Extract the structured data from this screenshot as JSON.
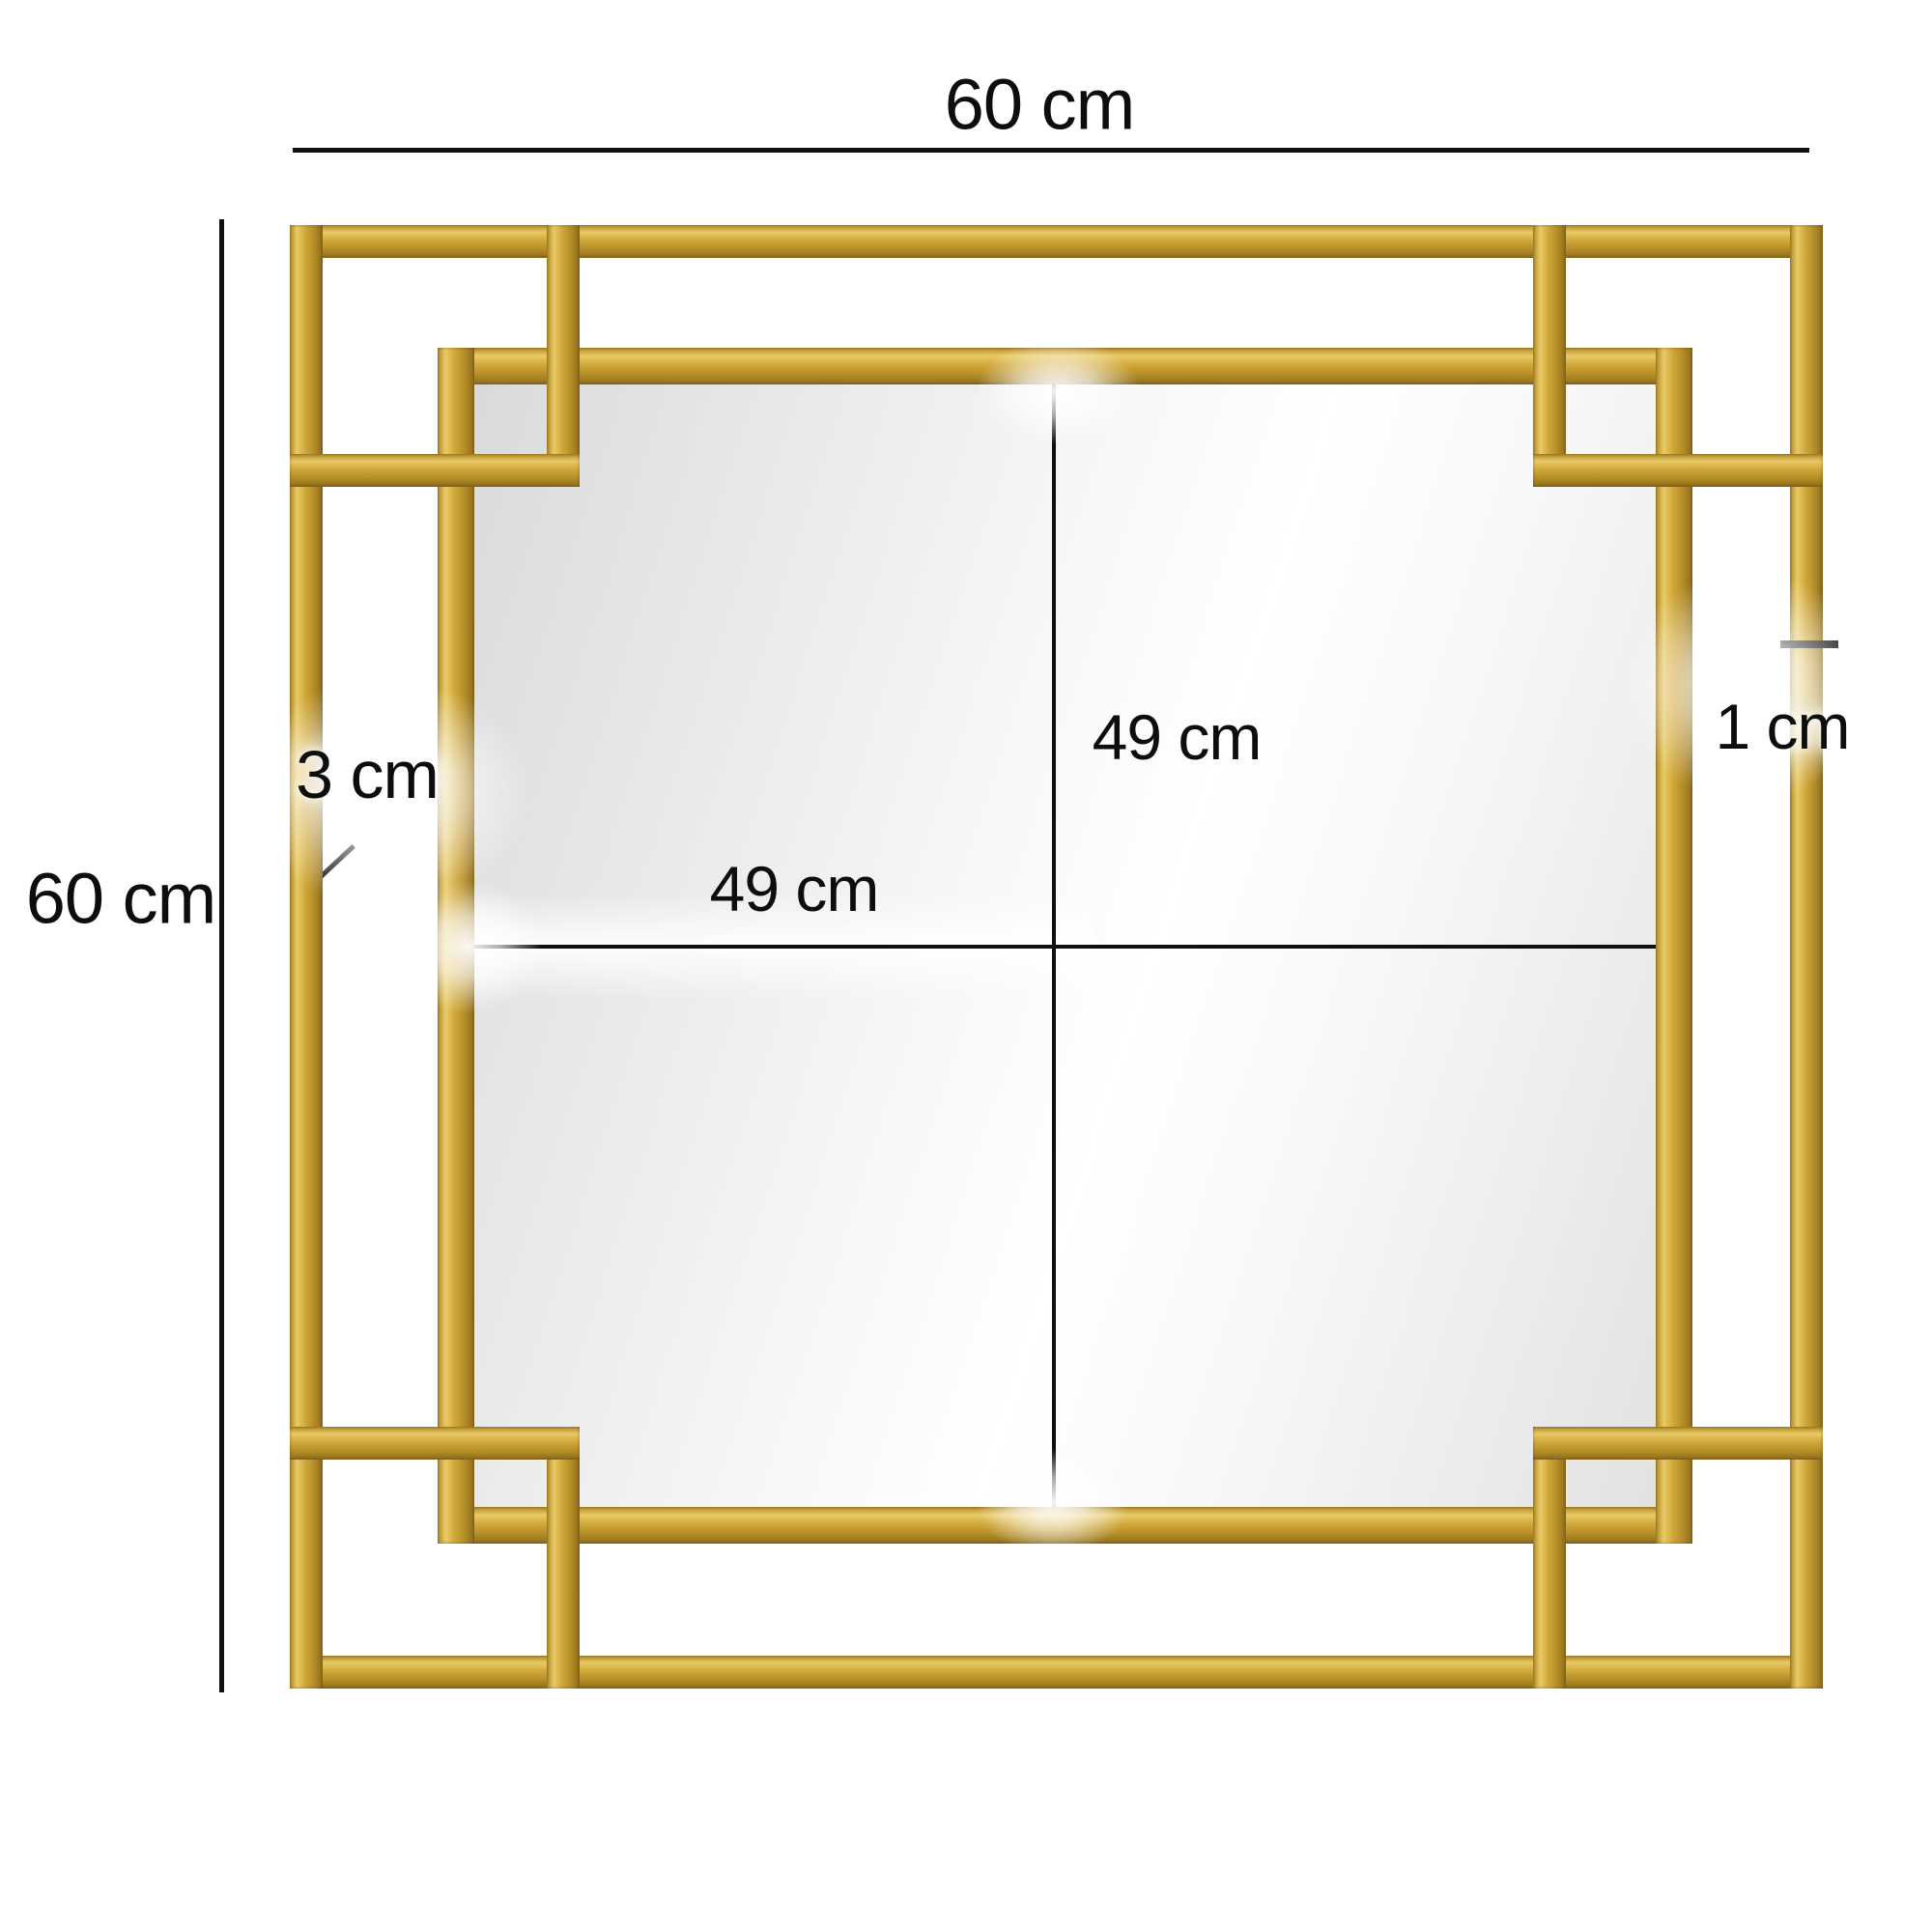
{
  "diagram": {
    "type": "product-dimension-diagram",
    "product": "square gold wall mirror with interlocking art-deco corner squares",
    "labels": {
      "outer_width": "60 cm",
      "outer_height": "60 cm",
      "mirror_height": "49 cm",
      "mirror_width": "49 cm",
      "frame_depth": "3 cm",
      "bar_thickness": "1 cm"
    },
    "colors": {
      "background": "#ffffff",
      "frame_gold": "#cfa637",
      "frame_gold_highlight": "#e9ca66",
      "frame_gold_shadow": "#8d6d1c",
      "dimension_line": "#101010",
      "glass_dark": "#d9dadb",
      "glass_light": "#ffffff"
    }
  }
}
